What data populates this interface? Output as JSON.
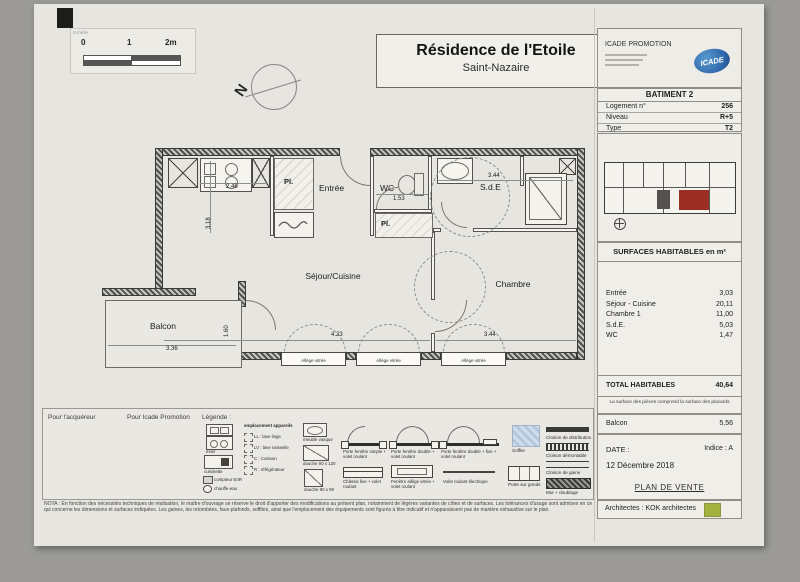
{
  "scale_bar": {
    "label": "Echelle",
    "tick0": "0",
    "tick1": "1",
    "tick2": "2m"
  },
  "north": {
    "letter": "N"
  },
  "title_block": {
    "title": "Résidence de l'Etoile",
    "subtitle": "Saint-Nazaire"
  },
  "promoter": {
    "name": "ICADE PROMOTION",
    "logo_text": "ICADE"
  },
  "batiment": {
    "header": "BATIMENT 2",
    "rows": [
      {
        "label": "Logement n°",
        "value": "256"
      },
      {
        "label": "Niveau",
        "value": "R+5"
      },
      {
        "label": "Type",
        "value": "T2"
      }
    ]
  },
  "surfaces": {
    "header": "SURFACES HABITABLES en m²",
    "rows": [
      {
        "label": "Entrée",
        "value": "3,03"
      },
      {
        "label": "Séjour - Cuisine",
        "value": "20,11"
      },
      {
        "label": "Chambre 1",
        "value": "11,00"
      },
      {
        "label": "S.d.E.",
        "value": "5,03"
      },
      {
        "label": "WC",
        "value": "1,47"
      }
    ],
    "total_label": "TOTAL HABITABLES",
    "total_value": "40,64",
    "note": "La surface des pièces comprend la surface des placards",
    "balcon_label": "Balcon",
    "balcon_value": "5,56"
  },
  "footer": {
    "date_label": "DATE :",
    "indice": "Indice : A",
    "date_value": "12 Décembre 2018",
    "plan_type": "PLAN DE VENTE",
    "architects": "Architectes : KOK architectes"
  },
  "plan": {
    "rooms": {
      "entree": "Entrée",
      "wc": "WC",
      "sde": "S.d.E",
      "pl1": "Pl.",
      "pl2": "Pl.",
      "sejour": "Séjour/Cuisine",
      "chambre": "Chambre",
      "balcon": "Balcon"
    },
    "dims": {
      "kitchen_w": "2.46",
      "kitchen_h": "3.18",
      "wc_w": "1.53",
      "sde_w": "3.44",
      "sejour_w": "4.23",
      "chambre_w": "3.44",
      "balcon_w": "3.36",
      "balcon_h": "1.60"
    },
    "window_label": "Allège vitrée"
  },
  "legend": {
    "for_buyer": "Pour l'acquéreur",
    "for_promoter": "Pour Icade Promotion",
    "title": "Légende :",
    "fixtures": {
      "evier": "évier",
      "cuisinette": "cuisinette",
      "compteur": "compteur EnR",
      "chauffe": "chauffe-eau",
      "vasque": "meuble vasque",
      "douche120": "douche 90 x 120",
      "douche90": "douche 90 x 90"
    },
    "appareils": {
      "header": "emplacement appareils",
      "ll": "LL : lave linge",
      "lv": "LV : lave vaisselle",
      "c": "C : Cuisson",
      "r": "R : réfrigérateur"
    },
    "openings": {
      "pf_simple": "Porte fenêtre simple + volet roulant",
      "pf_double": "Porte fenêtre double + volet roulant",
      "pf_double_fixe": "Porte fenêtre double + fixe + volet roulant",
      "chassis": "Châssis fixe + volet roulant",
      "fenetre": "Fenêtre allège vitrée + volet roulant",
      "volet": "Volet roulant électrique"
    },
    "walls": {
      "soffite": "Soffite",
      "porte_gonds": "Porte sur gonds",
      "cloison_dist": "Cloison de distribution",
      "cloison_dem": "Cloison démontable",
      "cloison_gaine": "Cloison de gaine",
      "mur": "Mur + doublage"
    }
  },
  "nota": "NOTA : En fonction des nécessités techniques de réalisation, le maître d'ouvrage se réserve le droit d'apporter des modifications au présent plan, notamment de légères variantes de côtes et de surfaces. Les tolérances d'usage sont admises en ce qui concerne les dimensions et surfaces indiquées. Les gaines, les retombées, faux-plafonds, soffites, ainsi que l'emplacement des équipements sont figurés à titre indicatif et n'apparaissent pas de manière exhaustive sur le plan."
}
